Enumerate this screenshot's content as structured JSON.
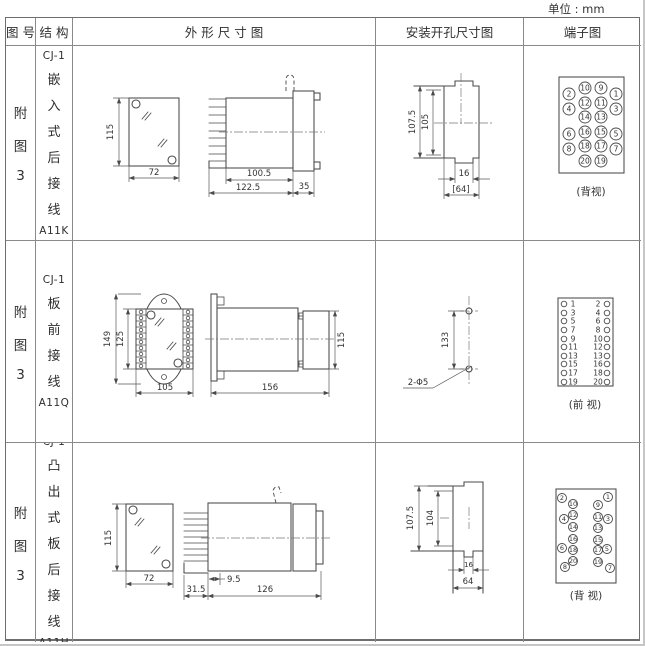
{
  "unit_label": "单位 : mm",
  "header": {
    "fig_no": "图 号",
    "structure": "结 构",
    "outline": "外 形 尺 寸 图",
    "install": "安装开孔尺寸图",
    "terminal": "端子图"
  },
  "rows": [
    {
      "fig_no": [
        "附",
        "图",
        "3"
      ],
      "structure": [
        "CJ-1",
        "嵌",
        "入",
        "式",
        "后",
        "接",
        "线",
        "A11K"
      ],
      "outline": {
        "h": "115",
        "w": "72",
        "d1": "100.5",
        "d2": "122.5",
        "d3": "35"
      },
      "install": {
        "v1": "107.5",
        "v2": "105",
        "n1": "16",
        "n2": "[64]"
      },
      "terminal": {
        "view": "(背视)",
        "outer_left": [
          "2",
          "4",
          "6",
          "8"
        ],
        "inner_left": [
          "10",
          "12",
          "14",
          "16",
          "18",
          "20"
        ],
        "inner_right": [
          "9",
          "11",
          "13",
          "15",
          "17",
          "19"
        ],
        "outer_right": [
          "1",
          "3",
          "5",
          "7"
        ]
      }
    },
    {
      "fig_no": [
        "附",
        "图",
        "3"
      ],
      "structure": [
        "CJ-1",
        "板",
        "前",
        "接",
        "线",
        "A11Q"
      ],
      "outline": {
        "h1": "149",
        "h2": "125",
        "w": "105",
        "d": "156",
        "rear_h": "115"
      },
      "install": {
        "v1": "133",
        "holes": "2-Φ5"
      },
      "terminal": {
        "view": "(前 视)",
        "left": [
          "1",
          "3",
          "5",
          "7",
          "9",
          "11",
          "13",
          "15",
          "17",
          "19"
        ],
        "right": [
          "2",
          "4",
          "6",
          "8",
          "10",
          "12",
          "13",
          "16",
          "18",
          "20"
        ]
      }
    },
    {
      "fig_no": [
        "附",
        "图",
        "3"
      ],
      "structure": [
        "CJ-1",
        "凸",
        "出",
        "式",
        "板",
        "后",
        "接",
        "线",
        "A11H"
      ],
      "outline": {
        "h": "115",
        "w": "72",
        "d1": "31.5",
        "d2": "9.5",
        "d3": "126"
      },
      "install": {
        "v1": "107.5",
        "v2": "104",
        "n1": "16",
        "n2": "64"
      },
      "terminal": {
        "view": "(背 视)",
        "outer_left": [
          "2",
          "4",
          "6",
          "8"
        ],
        "inner_left": [
          "10",
          "12",
          "14",
          "16",
          "18",
          "20"
        ],
        "inner_right": [
          "9",
          "11",
          "13",
          "15",
          "17",
          "19"
        ],
        "outer_right": [
          "1",
          "3",
          "5",
          "7"
        ]
      }
    }
  ]
}
